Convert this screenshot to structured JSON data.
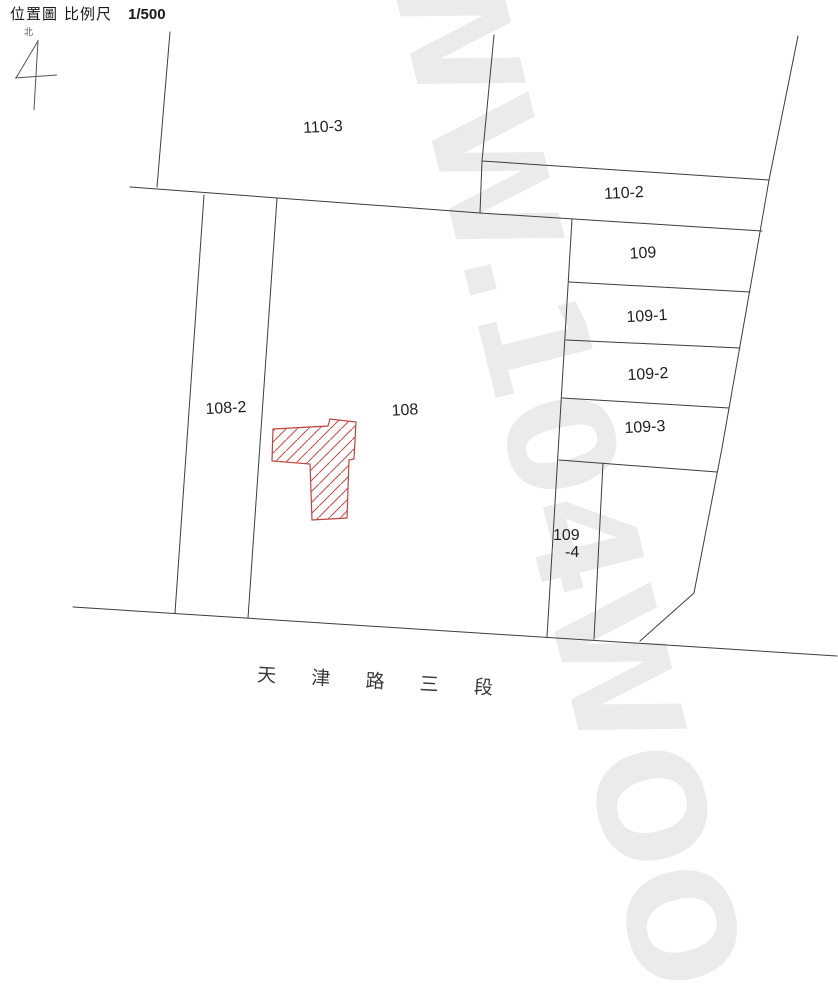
{
  "header": {
    "title": "位置圖",
    "scale_label": "比例尺",
    "scale_value": "1/500",
    "north_label": "北"
  },
  "parcels": [
    {
      "id": "110-3",
      "label": "110-3"
    },
    {
      "id": "110-2",
      "label": "110-2"
    },
    {
      "id": "109",
      "label": "109"
    },
    {
      "id": "109-1",
      "label": "109-1"
    },
    {
      "id": "109-2",
      "label": "109-2"
    },
    {
      "id": "109-3",
      "label": "109-3"
    },
    {
      "id": "108-2",
      "label": "108-2"
    },
    {
      "id": "108",
      "label": "108"
    },
    {
      "id": "109-4",
      "label_line1": "109",
      "label_line2": "-4"
    }
  ],
  "road": {
    "name": "天 津 路 三 段"
  },
  "building": {
    "description": "hatched building footprint inside parcel 108",
    "outline_color": "#c0443e",
    "hatch_color": "#c4534d"
  },
  "watermark": {
    "text": "WW.104WOO"
  },
  "colors": {
    "boundary_line": "#3d3d3d",
    "label_text": "#1f1f1f"
  }
}
